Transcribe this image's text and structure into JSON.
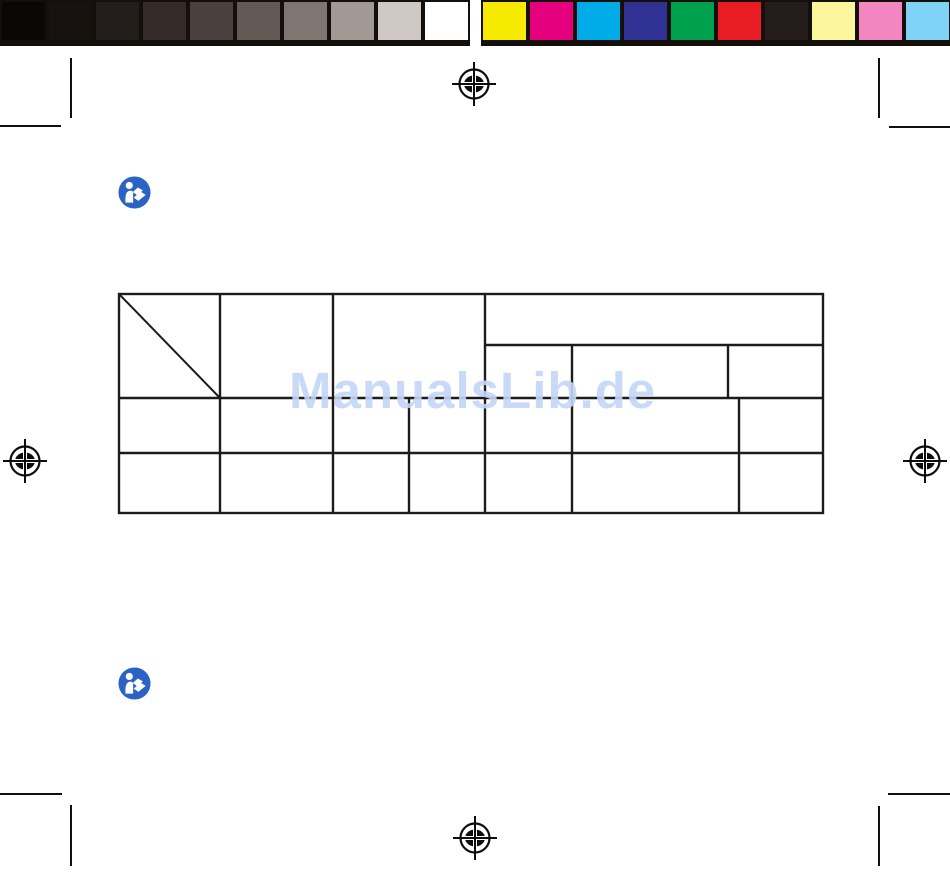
{
  "watermark": {
    "text": "ManualsLib.de",
    "color": "#c3d7f7",
    "opacity": 0.9
  },
  "calibration_bars": {
    "strip_background": "#150f0c",
    "grayscale": [
      "#0a0706",
      "#171110",
      "#231d1b",
      "#342b28",
      "#4a413e",
      "#635a56",
      "#7f7671",
      "#a29894",
      "#cfc7c4",
      "#ffffff"
    ],
    "colors": [
      "#f6eb00",
      "#e5007d",
      "#00ace8",
      "#2f3193",
      "#00a14e",
      "#e81d24",
      "#241d1b",
      "#fcf69c",
      "#f186c0",
      "#7ed3f7"
    ]
  },
  "manual_icons": {
    "glyph": "read-manual",
    "color": "#2a63c4",
    "count": 2
  },
  "registration_marks": {
    "color": "#0d0d0d",
    "positions": [
      "top-center",
      "left-middle",
      "right-middle",
      "bottom-center"
    ]
  },
  "crop_marks": {
    "color": "#101010",
    "corners": [
      "top-left",
      "top-right",
      "bottom-left",
      "bottom-right"
    ]
  },
  "table": {
    "line_color": "#1c1c1c",
    "body_rows": 2,
    "body_columns": 7,
    "header_has_diagonal_cell": true,
    "header_merged_section_subcolumns": 3,
    "cells_empty": true
  }
}
